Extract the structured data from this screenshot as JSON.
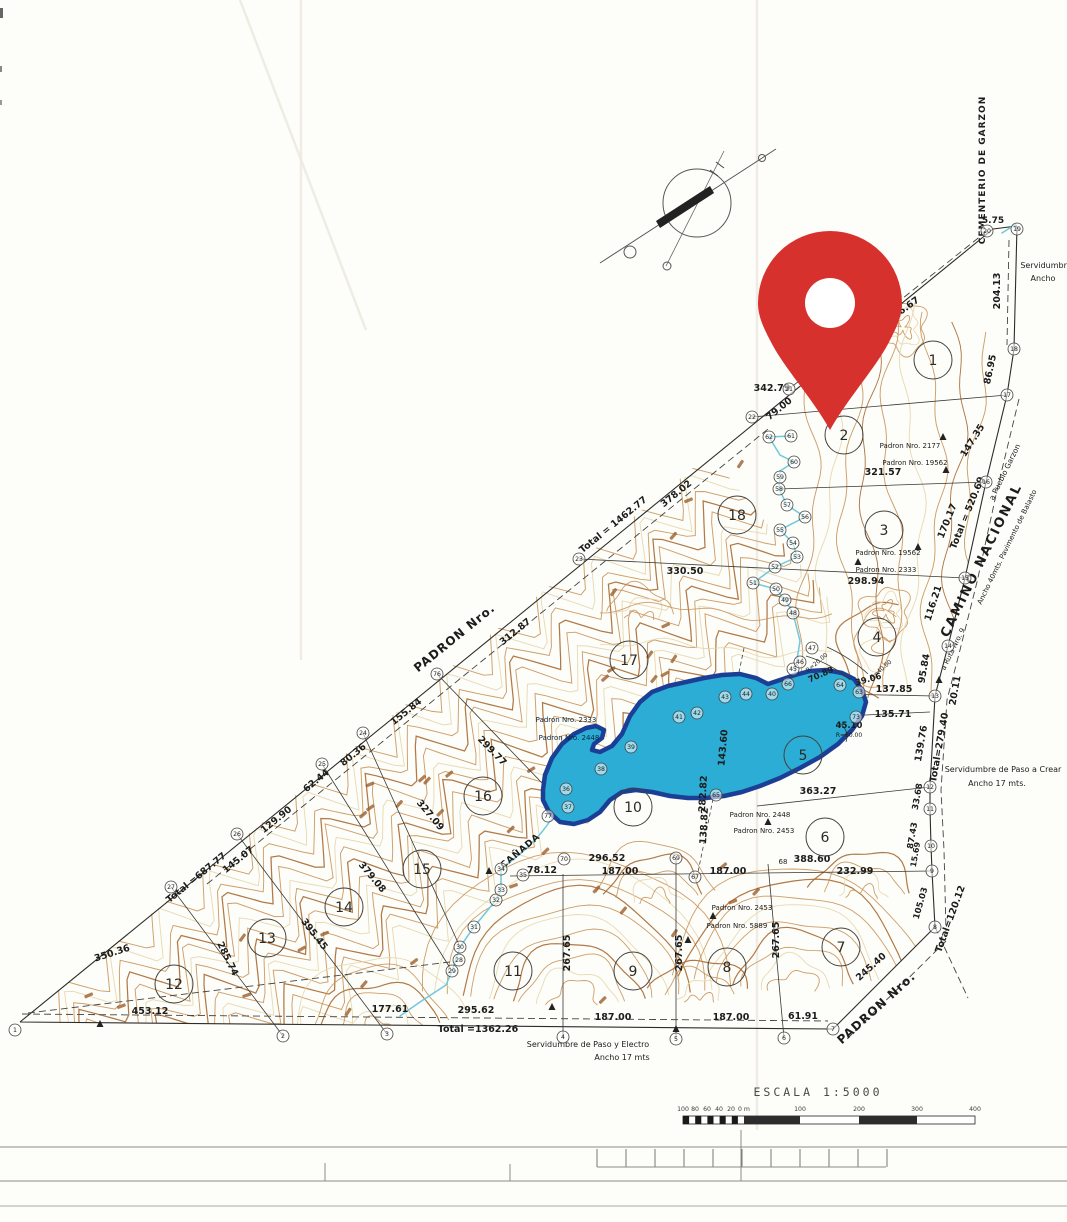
{
  "page": {
    "type": "Scanned land survey plan with red location pin overlay"
  },
  "overlay": {
    "pin_color": "#d7312e"
  },
  "map": {
    "colors": {
      "lake_fill": "#2badd6",
      "lake_border": "#1c3f96",
      "stream": "#6ec9de",
      "contour_mid": "#c99358",
      "contour_light": "#e7d6ab",
      "contour_dark": "#a96a33",
      "ink": "#2e2c28"
    },
    "scale": {
      "title": "ESCALA 1:5000",
      "ticks_left": [
        "100",
        "80",
        "60",
        "40",
        "20",
        "0 m"
      ],
      "ticks_right": [
        "100",
        "200",
        "300",
        "400"
      ]
    },
    "labels": [
      {
        "t": "CEMENTERIO DE GARZON",
        "x": 985,
        "y": 170,
        "r": -90,
        "s": 9,
        "ls": 1
      },
      {
        "t": "5.75",
        "x": 993,
        "y": 223,
        "s": 9
      },
      {
        "t": "204.13",
        "x": 1000,
        "y": 291,
        "r": -90
      },
      {
        "t": "Servidumbre",
        "x": 1046,
        "y": 268,
        "s": 8,
        "w": 400
      },
      {
        "t": "Ancho",
        "x": 1043,
        "y": 281,
        "s": 8,
        "w": 400
      },
      {
        "t": "456.67",
        "x": 905,
        "y": 312,
        "r": -36
      },
      {
        "t": "86.95",
        "x": 993,
        "y": 370,
        "r": -78
      },
      {
        "t": "342.79",
        "x": 772,
        "y": 391
      },
      {
        "t": "79.00",
        "x": 781,
        "y": 411,
        "r": -39
      },
      {
        "t": "147.35",
        "x": 975,
        "y": 442,
        "r": -58
      },
      {
        "t": "321.57",
        "x": 883,
        "y": 475
      },
      {
        "t": "Padron Nro. 2177",
        "x": 910,
        "y": 448,
        "s": 7,
        "w": 400
      },
      {
        "t": "Padron Nro. 19562",
        "x": 915,
        "y": 465,
        "s": 7,
        "w": 400
      },
      {
        "t": "Total = 520.69",
        "x": 970,
        "y": 514,
        "r": -68
      },
      {
        "t": "170.17",
        "x": 950,
        "y": 522,
        "r": -68
      },
      {
        "t": "CAMINO NACIONAL",
        "x": 985,
        "y": 562,
        "r": -64,
        "s": 13,
        "ls": 2
      },
      {
        "t": "a Pueblo Garzon",
        "x": 1007,
        "y": 473,
        "r": -64,
        "s": 7.5,
        "w": 400
      },
      {
        "t": "Ancho 40mts. Pavimento de Balasto",
        "x": 1009,
        "y": 548,
        "r": -64,
        "s": 7,
        "w": 400
      },
      {
        "t": "Total = 1462.77",
        "x": 615,
        "y": 527,
        "r": -39
      },
      {
        "t": "378.02",
        "x": 678,
        "y": 496,
        "r": -39
      },
      {
        "t": "PADRON Nro.",
        "x": 457,
        "y": 641,
        "r": -39,
        "s": 12,
        "ls": 1
      },
      {
        "t": "330.50",
        "x": 685,
        "y": 574
      },
      {
        "t": "298.94",
        "x": 866,
        "y": 584
      },
      {
        "t": "Padron Nro. 19562",
        "x": 888,
        "y": 555,
        "s": 7,
        "w": 400
      },
      {
        "t": "Padron Nro. 2333",
        "x": 886,
        "y": 572,
        "s": 7,
        "w": 400
      },
      {
        "t": "312.87",
        "x": 517,
        "y": 634,
        "r": -39
      },
      {
        "t": "116.21",
        "x": 936,
        "y": 604,
        "r": -72
      },
      {
        "t": "95.84",
        "x": 927,
        "y": 669,
        "r": -80
      },
      {
        "t": "20.11",
        "x": 958,
        "y": 691,
        "r": -80
      },
      {
        "t": "a Ruta Nro. 9",
        "x": 955,
        "y": 650,
        "r": -64,
        "s": 7,
        "w": 400
      },
      {
        "t": "137.85",
        "x": 894,
        "y": 692
      },
      {
        "t": "70.89",
        "x": 822,
        "y": 677,
        "r": -25,
        "s": 8.5
      },
      {
        "t": "R=20.00",
        "x": 818,
        "y": 664,
        "r": -40,
        "s": 6,
        "w": 400
      },
      {
        "t": "39.06",
        "x": 869,
        "y": 682,
        "r": -15,
        "s": 8.5
      },
      {
        "t": "R=40.00",
        "x": 882,
        "y": 671,
        "r": -40,
        "s": 6,
        "w": 400
      },
      {
        "t": "135.71",
        "x": 893,
        "y": 717
      },
      {
        "t": "45.10",
        "x": 849,
        "y": 728,
        "s": 8.5
      },
      {
        "t": "R=60.00",
        "x": 849,
        "y": 737,
        "s": 6,
        "w": 400
      },
      {
        "t": "139.76",
        "x": 924,
        "y": 744,
        "r": -80
      },
      {
        "t": "Total=279.40",
        "x": 942,
        "y": 748,
        "r": -80
      },
      {
        "t": "155.84",
        "x": 408,
        "y": 714,
        "r": -39
      },
      {
        "t": "80.36",
        "x": 355,
        "y": 757,
        "r": -39
      },
      {
        "t": "62.44",
        "x": 318,
        "y": 783,
        "r": -39
      },
      {
        "t": "129.90",
        "x": 278,
        "y": 822,
        "r": -39
      },
      {
        "t": "299.77",
        "x": 490,
        "y": 753,
        "r": 46
      },
      {
        "t": "143.60",
        "x": 726,
        "y": 748,
        "r": -85
      },
      {
        "t": "282.82",
        "x": 706,
        "y": 794,
        "r": -87
      },
      {
        "t": "138.82",
        "x": 707,
        "y": 826,
        "r": -87
      },
      {
        "t": "363.27",
        "x": 818,
        "y": 794
      },
      {
        "t": "Servidumbre de Paso a Crear",
        "x": 1003,
        "y": 772,
        "s": 8,
        "w": 400
      },
      {
        "t": "Ancho 17 mts.",
        "x": 997,
        "y": 786,
        "s": 8,
        "w": 400
      },
      {
        "t": "33.68",
        "x": 920,
        "y": 797,
        "r": -80,
        "s": 8.5
      },
      {
        "t": "87.43",
        "x": 915,
        "y": 836,
        "r": -80,
        "s": 8.5
      },
      {
        "t": "15.69",
        "x": 918,
        "y": 855,
        "r": -80,
        "s": 8
      },
      {
        "t": "105.03",
        "x": 923,
        "y": 904,
        "r": -74,
        "s": 8.5
      },
      {
        "t": "Total=120.12",
        "x": 953,
        "y": 920,
        "r": -70
      },
      {
        "t": "Padron Nro. 2448",
        "x": 760,
        "y": 817,
        "s": 7,
        "w": 400
      },
      {
        "t": "Padron Nro. 2453",
        "x": 764,
        "y": 833,
        "s": 7,
        "w": 400
      },
      {
        "t": "CAÑADA",
        "x": 522,
        "y": 853,
        "r": -40,
        "s": 9,
        "ls": 1
      },
      {
        "t": "78.12",
        "x": 542,
        "y": 873
      },
      {
        "t": "296.52",
        "x": 607,
        "y": 861
      },
      {
        "t": "187.00",
        "x": 620,
        "y": 874
      },
      {
        "t": "187.00",
        "x": 728,
        "y": 874
      },
      {
        "t": "68",
        "x": 783,
        "y": 864,
        "s": 7,
        "w": 400
      },
      {
        "t": "388.60",
        "x": 812,
        "y": 862
      },
      {
        "t": "232.99",
        "x": 855,
        "y": 874
      },
      {
        "t": "Padron Nro. 2453",
        "x": 742,
        "y": 910,
        "s": 7,
        "w": 400
      },
      {
        "t": "Padron Nro. 5889",
        "x": 737,
        "y": 928,
        "s": 7,
        "w": 400
      },
      {
        "t": "267.65",
        "x": 570,
        "y": 953,
        "r": -90
      },
      {
        "t": "267.65",
        "x": 682,
        "y": 953,
        "r": -90
      },
      {
        "t": "267.65",
        "x": 779,
        "y": 940,
        "r": -90
      },
      {
        "t": "379.08",
        "x": 370,
        "y": 879,
        "r": 50
      },
      {
        "t": "327.09",
        "x": 428,
        "y": 817,
        "r": 50
      },
      {
        "t": "395.45",
        "x": 312,
        "y": 936,
        "r": 52
      },
      {
        "t": "285.74",
        "x": 225,
        "y": 960,
        "r": 64
      },
      {
        "t": "Total =687.77",
        "x": 198,
        "y": 880,
        "r": -39
      },
      {
        "t": "145.07",
        "x": 240,
        "y": 862,
        "r": -39
      },
      {
        "t": "350.36",
        "x": 113,
        "y": 956,
        "r": -18
      },
      {
        "t": "453.12",
        "x": 150,
        "y": 1014
      },
      {
        "t": "177.61",
        "x": 390,
        "y": 1012
      },
      {
        "t": "295.62",
        "x": 476,
        "y": 1013
      },
      {
        "t": "Total =1362.26",
        "x": 478,
        "y": 1032
      },
      {
        "t": "187.00",
        "x": 613,
        "y": 1020
      },
      {
        "t": "187.00",
        "x": 731,
        "y": 1020
      },
      {
        "t": "61.91",
        "x": 803,
        "y": 1019
      },
      {
        "t": "245.40",
        "x": 873,
        "y": 969,
        "r": -42
      },
      {
        "t": "PADRON Nro.",
        "x": 879,
        "y": 1011,
        "r": -42,
        "s": 12,
        "ls": 1
      },
      {
        "t": "Servidumbre de Paso y Electro",
        "x": 588,
        "y": 1047,
        "s": 8,
        "w": 400
      },
      {
        "t": "Ancho 17 mts",
        "x": 622,
        "y": 1060,
        "s": 8,
        "w": 400
      },
      {
        "t": "Padron Nro. 2333",
        "x": 566,
        "y": 722,
        "s": 7,
        "w": 400,
        "c": "#0d2438"
      },
      {
        "t": "Padron Nro. 2448",
        "x": 569,
        "y": 740,
        "s": 7,
        "w": 400,
        "c": "#0d2438"
      }
    ],
    "parcels": [
      [
        "1",
        933,
        360
      ],
      [
        "2",
        844,
        435
      ],
      [
        "3",
        884,
        530
      ],
      [
        "4",
        877,
        637
      ],
      [
        "5",
        803,
        755
      ],
      [
        "6",
        825,
        837
      ],
      [
        "7",
        841,
        947
      ],
      [
        "8",
        727,
        967
      ],
      [
        "9",
        633,
        971
      ],
      [
        "10",
        633,
        807
      ],
      [
        "11",
        513,
        971
      ],
      [
        "12",
        174,
        984
      ],
      [
        "13",
        267,
        938
      ],
      [
        "14",
        344,
        907
      ],
      [
        "15",
        422,
        869
      ],
      [
        "16",
        483,
        796
      ],
      [
        "17",
        629,
        660
      ],
      [
        "18",
        737,
        515
      ]
    ],
    "points": [
      [
        "1",
        15,
        1030
      ],
      [
        "2",
        283,
        1036
      ],
      [
        "3",
        387,
        1034
      ],
      [
        "4",
        563,
        1037
      ],
      [
        "5",
        676,
        1039
      ],
      [
        "6",
        784,
        1038
      ],
      [
        "7",
        833,
        1029
      ],
      [
        "8",
        935,
        927
      ],
      [
        "9",
        932,
        871
      ],
      [
        "10",
        931,
        846
      ],
      [
        "11",
        930,
        809
      ],
      [
        "12",
        930,
        787
      ],
      [
        "13",
        935,
        696
      ],
      [
        "14",
        948,
        646
      ],
      [
        "15",
        965,
        578
      ],
      [
        "16",
        986,
        482
      ],
      [
        "17",
        1007,
        395
      ],
      [
        "18",
        1014,
        349
      ],
      [
        "19",
        1017,
        229
      ],
      [
        "20",
        987,
        231
      ],
      [
        "21",
        789,
        389
      ],
      [
        "22",
        752,
        417
      ],
      [
        "23",
        579,
        559
      ],
      [
        "24",
        363,
        733
      ],
      [
        "25",
        322,
        764
      ],
      [
        "26",
        237,
        834
      ],
      [
        "27",
        171,
        887
      ],
      [
        "28",
        459,
        960
      ],
      [
        "29",
        452,
        971
      ],
      [
        "30",
        460,
        947
      ],
      [
        "31",
        474,
        927
      ],
      [
        "32",
        496,
        900
      ],
      [
        "33",
        501,
        890
      ],
      [
        "34",
        501,
        869
      ],
      [
        "35",
        523,
        875
      ],
      [
        "36",
        566,
        789
      ],
      [
        "37",
        568,
        807
      ],
      [
        "38",
        601,
        769
      ],
      [
        "39",
        631,
        747
      ],
      [
        "40",
        772,
        694
      ],
      [
        "41",
        679,
        717
      ],
      [
        "42",
        697,
        713
      ],
      [
        "43",
        725,
        697
      ],
      [
        "44",
        746,
        694
      ],
      [
        "45",
        793,
        669
      ],
      [
        "46",
        800,
        662
      ],
      [
        "47",
        812,
        648
      ],
      [
        "48",
        793,
        613
      ],
      [
        "49",
        785,
        600
      ],
      [
        "50",
        776,
        589
      ],
      [
        "51",
        753,
        583
      ],
      [
        "52",
        775,
        567
      ],
      [
        "53",
        797,
        557
      ],
      [
        "54",
        793,
        543
      ],
      [
        "55",
        780,
        530
      ],
      [
        "56",
        805,
        517
      ],
      [
        "57",
        787,
        505
      ],
      [
        "58",
        779,
        489
      ],
      [
        "59",
        780,
        477
      ],
      [
        "60",
        794,
        462
      ],
      [
        "61",
        791,
        436
      ],
      [
        "62",
        769,
        437
      ],
      [
        "63",
        859,
        692
      ],
      [
        "64",
        840,
        685
      ],
      [
        "65",
        716,
        795
      ],
      [
        "66",
        788,
        684
      ],
      [
        "67",
        695,
        877
      ],
      [
        "69",
        676,
        858
      ],
      [
        "70",
        564,
        859
      ],
      [
        "73",
        856,
        717
      ],
      [
        "76",
        437,
        674
      ],
      [
        "77",
        548,
        816
      ]
    ]
  }
}
